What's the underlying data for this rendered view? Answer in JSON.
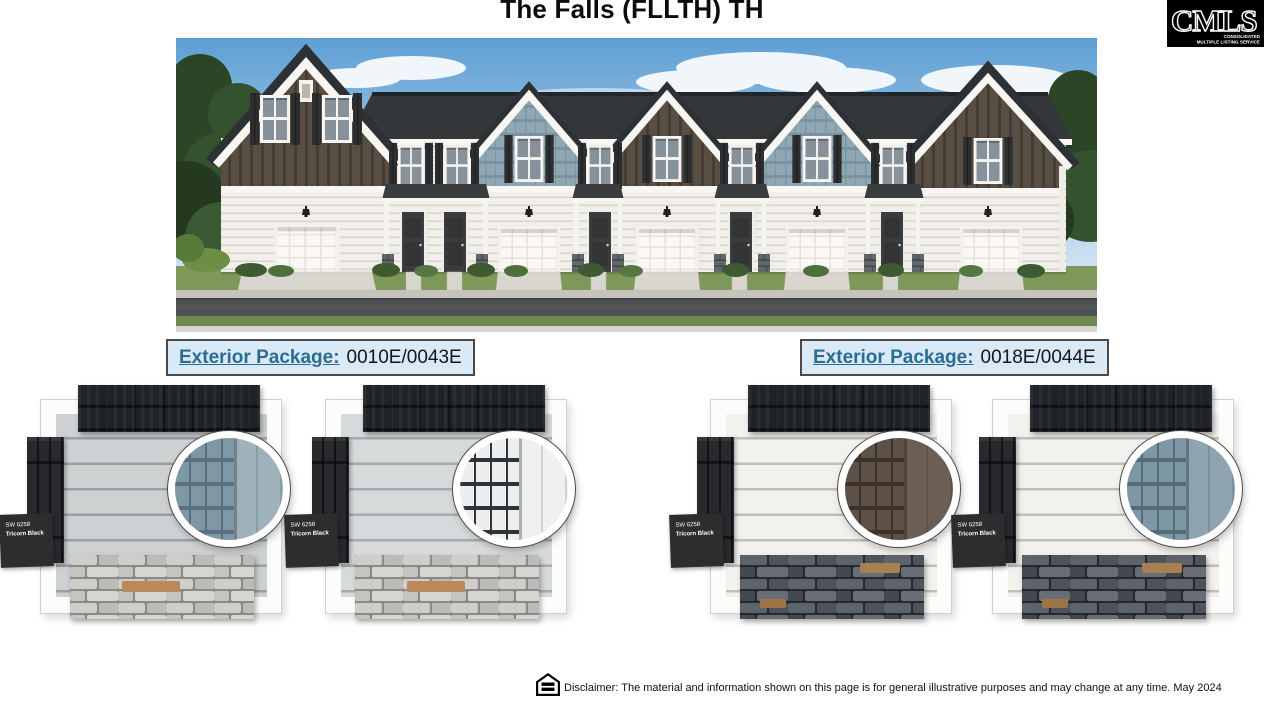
{
  "page": {
    "title": "The Falls (FLLTH) TH"
  },
  "cmls_logo": {
    "text": "CMLS",
    "subtext_line1": "CONSOLIDATED",
    "subtext_line2": "MULTIPLE LISTING SERVICE"
  },
  "rendering": {
    "alt": "Front elevation rendering of a six-unit townhome row with alternating brown board-and-batten and blue shake gables, white lap siding, garages, covered entries and stone accents"
  },
  "packages": [
    {
      "label": "Exterior Package:",
      "code": "0010E/0043E"
    },
    {
      "label": "Exterior Package:",
      "code": "0018E/0044E"
    }
  ],
  "swatch_panels": [
    {
      "paint_code": "SW 6258",
      "paint_name": "Tricorn Black",
      "stone_variant": "light",
      "colors": {
        "siding": "#cdd1d2",
        "siding_shadow": "#9aa0a3",
        "accent": "#7f98a6",
        "accent_dark": "#5a707d",
        "trim": "#9fb1bb"
      }
    },
    {
      "paint_code": "SW 6258",
      "paint_name": "Tricorn Black",
      "stone_variant": "light",
      "colors": {
        "siding": "#d7dadb",
        "siding_shadow": "#a6abad",
        "accent": "#eceeef",
        "accent_dark": "#303436",
        "trim": "#eff1f1"
      }
    },
    {
      "paint_code": "SW 6258",
      "paint_name": "Tricorn Black",
      "stone_variant": "dark",
      "colors": {
        "siding": "#f2f1ee",
        "siding_shadow": "#bfbeb9",
        "accent": "#5e5148",
        "accent_dark": "#3b322b",
        "trim": "#6b5e55"
      }
    },
    {
      "paint_code": "SW 6258",
      "paint_name": "Tricorn Black",
      "stone_variant": "dark",
      "colors": {
        "siding": "#f2f1ee",
        "siding_shadow": "#bfbeb9",
        "accent": "#7e97a5",
        "accent_dark": "#546c79",
        "trim": "#8ea4b0"
      }
    }
  ],
  "footer": {
    "disclaimer": "Disclaimer: The material and information shown on this page is for general illustrative purposes and may change at any time. May 2024"
  },
  "theme": {
    "package_label_color": "#2b6d92",
    "package_bg": "#d9e9f6",
    "paint_chip_bg": "#2d2d2f",
    "title_color": "#0c0c0c"
  }
}
